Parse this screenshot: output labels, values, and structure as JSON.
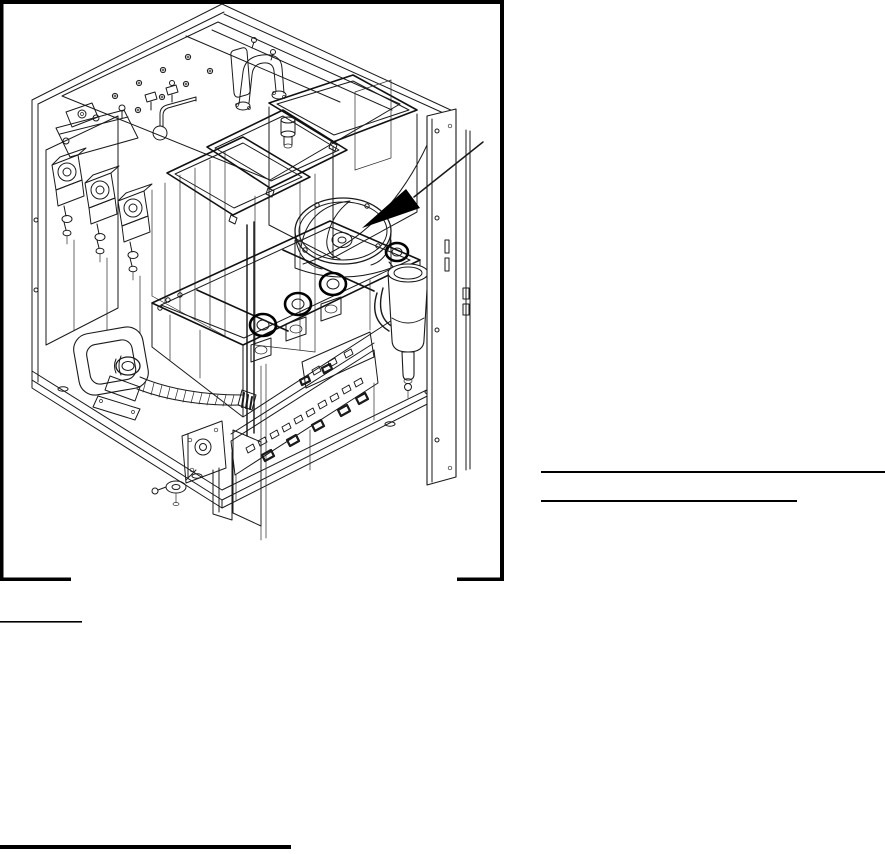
{
  "page": {
    "background": "#ffffff",
    "ink_color": "#000000",
    "width_px": 885,
    "height_px": 854
  },
  "figure": {
    "kind": "isometric-technical-line-drawing",
    "subject": "dispenser cabinet interior assembly (wireframe)",
    "frame_style": "thick black border open at bottom center",
    "callout": {
      "icon": "filled-triangle-arrow",
      "leader": "thin diagonal line from upper right",
      "points_to": "round-mixing-chamber"
    },
    "parts": [
      "cabinet-shell",
      "top-deck-hardware",
      "canister-lids",
      "right-canister",
      "mixing-bowl",
      "whipper-shelf",
      "whipper-rings",
      "inlet-valves",
      "drain-loop-tube",
      "corrugated-hose",
      "dispenser-funnel",
      "circuit-boards",
      "drain-bracket",
      "door-panel"
    ]
  },
  "annotations": {
    "blank_line_right_1": "",
    "blank_line_right_2": "",
    "blank_line_note_left": "",
    "footnote_rule": ""
  }
}
